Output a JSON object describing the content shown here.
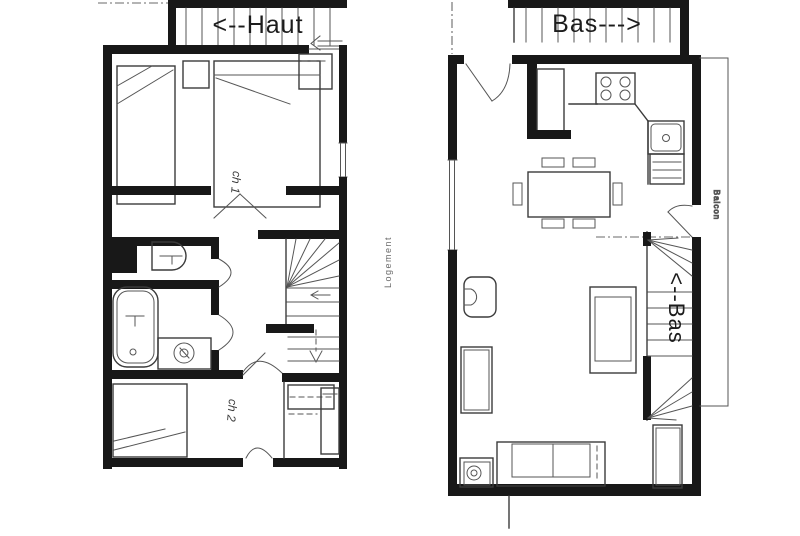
{
  "colors": {
    "paper": "#ffffff",
    "ink": "#181818",
    "line": "#3b3b3b",
    "muted": "#6b6b6b"
  },
  "upper_plan": {
    "exterior_stair_label": "<--Haut",
    "bedroom1_label": "ch 1",
    "bedroom2_label": "ch 2",
    "vertical_note": "Logement"
  },
  "lower_plan": {
    "exterior_stair_label": "Bas--->",
    "interior_stair_label": "<--Bas",
    "balcony_label": "Balcon"
  }
}
